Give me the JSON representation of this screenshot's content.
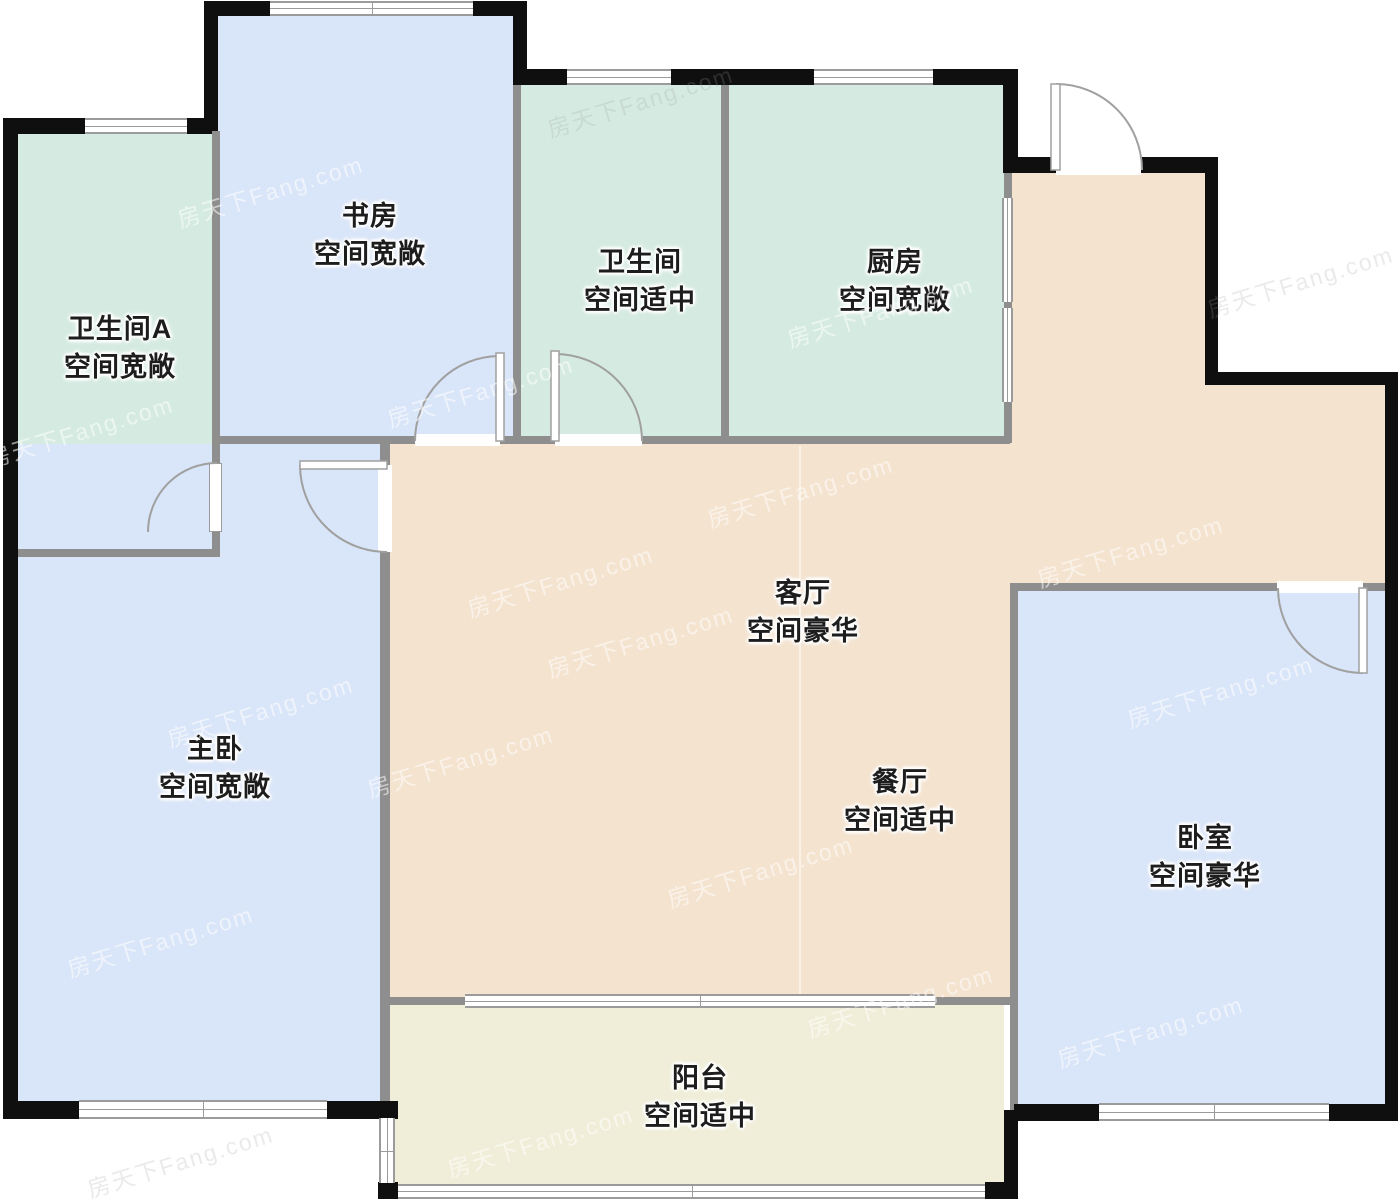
{
  "watermark": "房天下Fang.com",
  "rooms": [
    {
      "id": "bathroom-a",
      "name": "卫生间A",
      "quality": "空间宽敞",
      "color": "#d5ebe1"
    },
    {
      "id": "study",
      "name": "书房",
      "quality": "空间宽敞",
      "color": "#d9e5f8"
    },
    {
      "id": "bathroom",
      "name": "卫生间",
      "quality": "空间适中",
      "color": "#d5ebe1"
    },
    {
      "id": "kitchen",
      "name": "厨房",
      "quality": "空间宽敞",
      "color": "#d5ebe1"
    },
    {
      "id": "master-bedroom",
      "name": "主卧",
      "quality": "空间宽敞",
      "color": "#d9e5f8"
    },
    {
      "id": "living-room",
      "name": "客厅",
      "quality": "空间豪华",
      "color": "#f4e3cf"
    },
    {
      "id": "dining-room",
      "name": "餐厅",
      "quality": "空间适中",
      "color": "#f4e3cf"
    },
    {
      "id": "bedroom",
      "name": "卧室",
      "quality": "空间豪华",
      "color": "#d9e5f8"
    },
    {
      "id": "balcony",
      "name": "阳台",
      "quality": "空间适中",
      "color": "#f0eed8"
    }
  ],
  "palette": {
    "outer_wall": "#0f0f0f",
    "inner_wall": "#8e8e8e",
    "door_arc": "#a0a0a0",
    "window_frame": "#9b9b9b",
    "label_text": "#1d1d1d"
  }
}
